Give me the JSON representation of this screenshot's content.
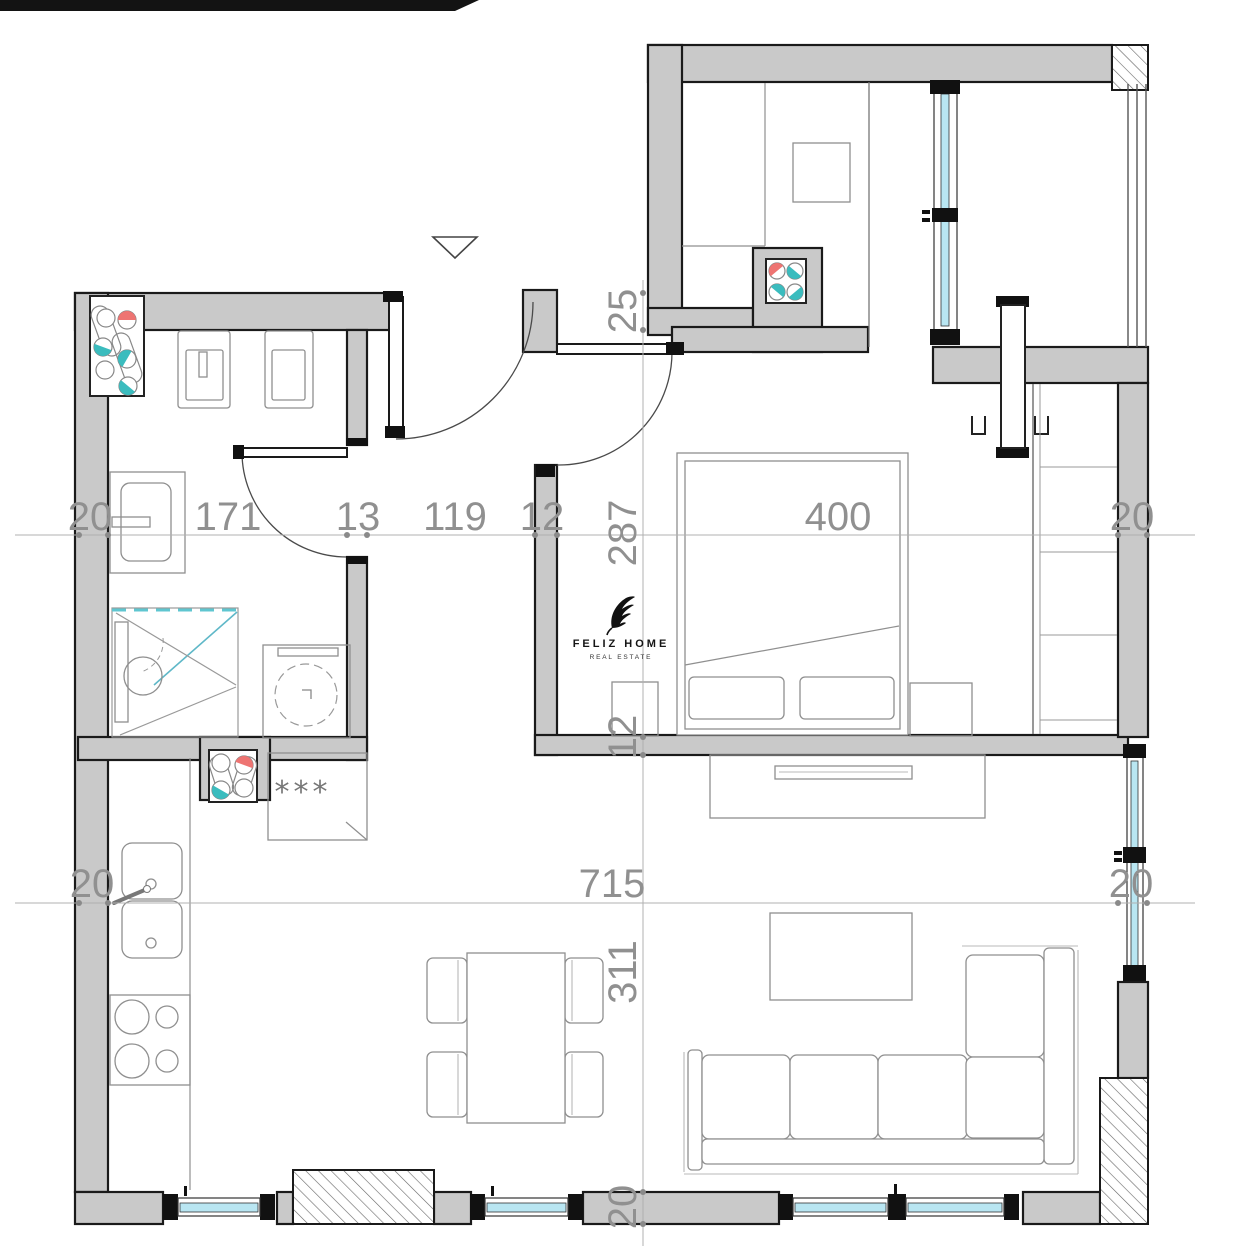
{
  "logo": {
    "name": "FELIZ HOME",
    "tagline": "REAL ESTATE"
  },
  "annotations": {
    "boiler": "***"
  },
  "dimensions": {
    "top": {
      "wall_left": "20",
      "bath_width": "171",
      "wall_mid": "13",
      "hall_width": "119",
      "wall_bedroom": "12",
      "bedroom_width": "400",
      "wall_right": "20"
    },
    "bottom": {
      "wall_left": "20",
      "living_width": "715",
      "wall_right": "20"
    },
    "vertical": {
      "entry": "25",
      "bedroom_depth": "287",
      "wall": "12",
      "living_depth": "311",
      "wall_bottom": "20"
    }
  }
}
